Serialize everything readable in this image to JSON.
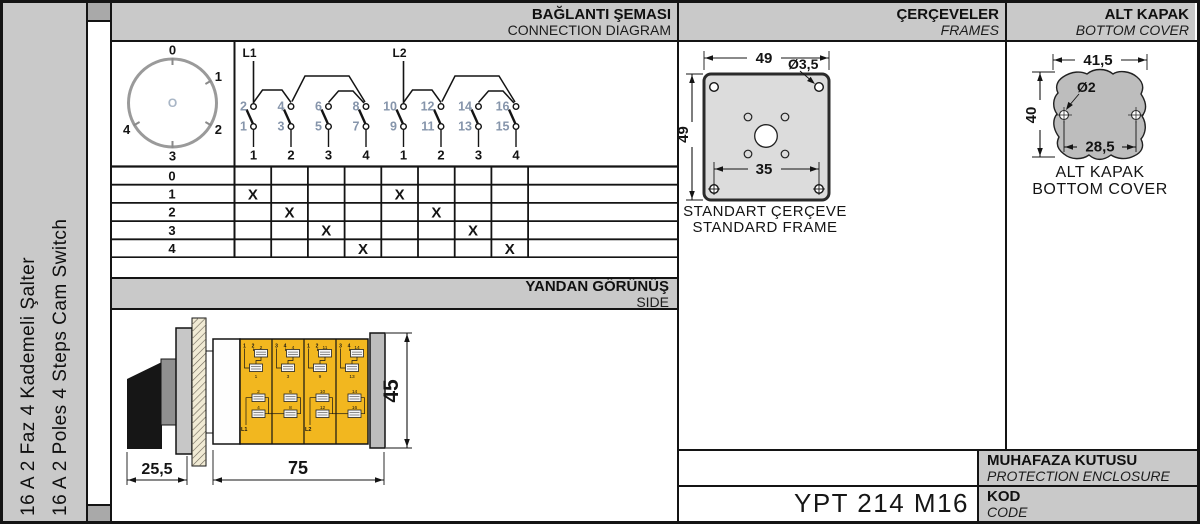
{
  "sidebar": {
    "title_tr": "16 A 2 Faz 4 Kademeli Şalter",
    "title_en": "16 A 2 Poles 4 Steps Cam Switch"
  },
  "headers": {
    "connection": {
      "tr": "BAĞLANTI ŞEMASI",
      "en": "CONNECTION DIAGRAM"
    },
    "frames": {
      "tr": "ÇERÇEVELER",
      "en": "FRAMES"
    },
    "bottom_cover": {
      "tr": "ALT KAPAK",
      "en": "BOTTOM COVER"
    },
    "side": {
      "tr": "YANDAN GÖRÜNÜŞ",
      "en": "SIDE"
    }
  },
  "dial": {
    "positions": [
      "0",
      "1",
      "2",
      "3",
      "4"
    ],
    "center": "O"
  },
  "diagram": {
    "feeds": [
      "L1",
      "L2"
    ],
    "top_terminals": [
      "2",
      "4",
      "6",
      "8",
      "10",
      "12",
      "14",
      "16"
    ],
    "bottom_terminals": [
      "1",
      "3",
      "5",
      "7",
      "9",
      "11",
      "13",
      "15"
    ],
    "columns": [
      "1",
      "2",
      "3",
      "4",
      "1",
      "2",
      "3",
      "4"
    ]
  },
  "table": {
    "mark": "X",
    "rows": [
      {
        "label": "0",
        "marks": [
          0,
          0,
          0,
          0,
          0,
          0,
          0,
          0
        ]
      },
      {
        "label": "1",
        "marks": [
          1,
          0,
          0,
          0,
          1,
          0,
          0,
          0
        ]
      },
      {
        "label": "2",
        "marks": [
          0,
          1,
          0,
          0,
          0,
          1,
          0,
          0
        ]
      },
      {
        "label": "3",
        "marks": [
          0,
          0,
          1,
          0,
          0,
          0,
          1,
          0
        ]
      },
      {
        "label": "4",
        "marks": [
          0,
          0,
          0,
          1,
          0,
          0,
          0,
          1
        ]
      }
    ]
  },
  "frame": {
    "dim_width": "49",
    "dim_height": "49",
    "dim_hole": "Ø3,5",
    "dim_spacing": "35",
    "label_tr": "STANDART ÇERÇEVE",
    "label_en": "STANDARD FRAME"
  },
  "cover": {
    "dim_width": "41,5",
    "dim_height": "40",
    "dim_hole": "Ø2",
    "dim_spacing": "28,5",
    "label_tr": "ALT KAPAK",
    "label_en": "BOTTOM COVER"
  },
  "side_view": {
    "dim_handle": "25,5",
    "dim_body": "75",
    "dim_height": "45",
    "modules": [
      {
        "corners": [
          "1",
          "2"
        ],
        "upper": [
          "2",
          "1"
        ],
        "lower": [
          "2",
          "4"
        ],
        "feed": "L1"
      },
      {
        "corners": [
          "3",
          "4"
        ],
        "upper": [
          "4",
          "3"
        ],
        "lower": [
          "6",
          "8"
        ],
        "feed": ""
      },
      {
        "corners": [
          "1",
          "2"
        ],
        "upper": [
          "11",
          "9"
        ],
        "lower": [
          "10",
          "12"
        ],
        "feed": "L2"
      },
      {
        "corners": [
          "3",
          "4"
        ],
        "upper": [
          "14",
          "13"
        ],
        "lower": [
          "14",
          "16"
        ],
        "feed": ""
      }
    ]
  },
  "footer": {
    "enclosure": {
      "tr": "MUHAFAZA KUTUSU",
      "en": "PROTECTION ENCLOSURE"
    },
    "code": {
      "tr": "KOD",
      "en": "CODE"
    },
    "code_value": "YPT 214 M16"
  },
  "colors": {
    "band_gray": "#c9c9c9",
    "frame_plate_gray": "#dcdcdc",
    "cover_gray": "#bdbdbd",
    "module_yellow": "#f2b71f",
    "panel_cream": "#f1ebd5",
    "terminal_number": "#8695ab",
    "line": "#141414"
  }
}
